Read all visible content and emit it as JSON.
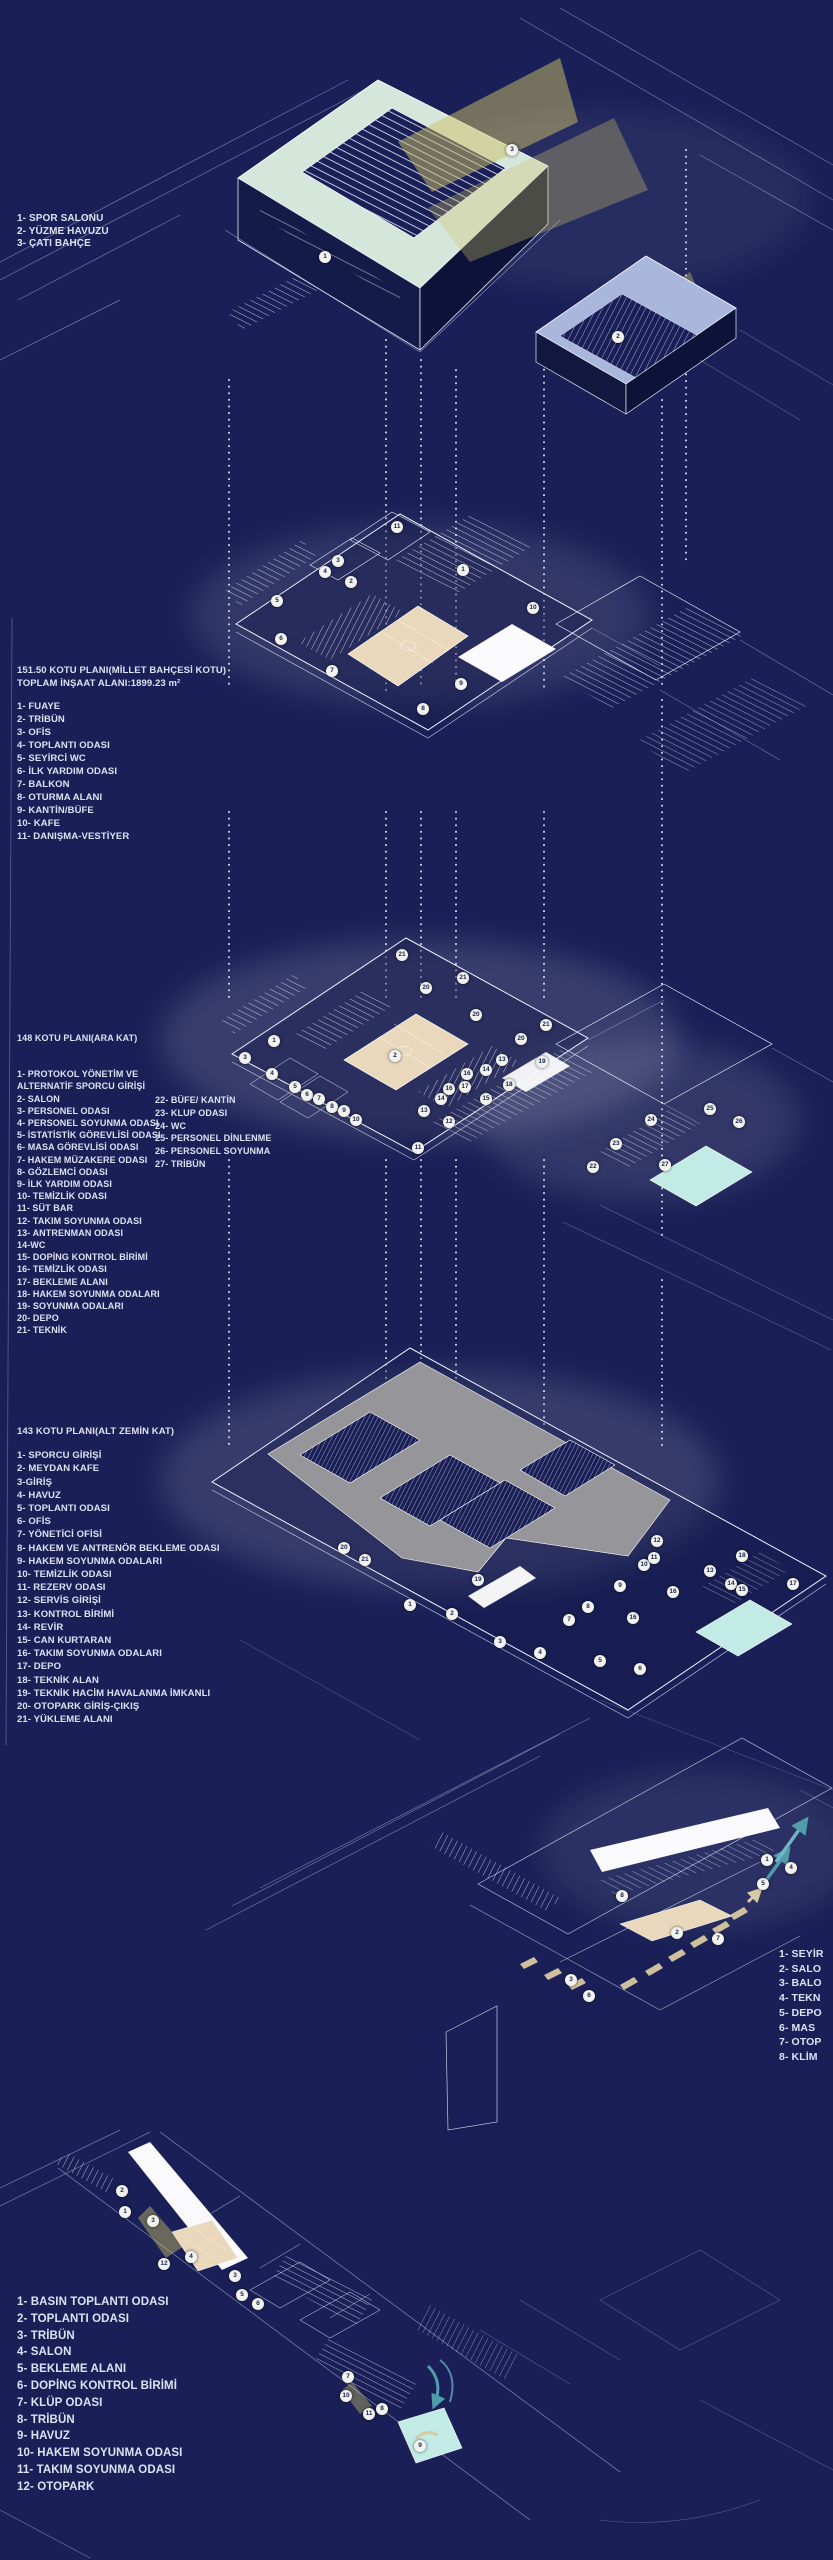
{
  "colors": {
    "background": "#1a2057",
    "line": "#dfe6f6",
    "court": "#ead8bd",
    "pool_water": "#c2ebe5",
    "parking_deck": "#96969a",
    "roof_garden": "#d5e6db",
    "pool_building_roof": "#a9b7dd",
    "light_beam": "#cdc267",
    "air_arrow_tan": "#d9c9a2",
    "air_arrow_teal": "#4f9cab",
    "text": "#dce2f1"
  },
  "legends": {
    "roof": {
      "items": [
        "1- SPOR SALONU",
        "2- YÜZME HAVUZU",
        "3- ÇATI BAHÇE"
      ]
    },
    "level_15150": {
      "title1": "151.50 KOTU PLANI(MİLLET BAHÇESİ KOTU)",
      "title2": "TOPLAM İNŞAAT ALANI:1899.23 m²",
      "items": [
        "1- FUAYE",
        "2- TRİBÜN",
        "3- OFİS",
        "4- TOPLANTI ODASI",
        "5- SEYİRCİ WC",
        "6- İLK YARDIM ODASI",
        "7- BALKON",
        "8- OTURMA ALANI",
        "9- KANTİN/BÜFE",
        "10- KAFE",
        "11- DANIŞMA-VESTİYER"
      ]
    },
    "level_148": {
      "title": "148 KOTU PLANI(ARA KAT)",
      "items_col1": [
        "1- PROTOKOL YÖNETİM VE ALTERNATİF SPORCU GİRİŞİ",
        "2- SALON",
        "3- PERSONEL ODASI",
        "4- PERSONEL SOYUNMA ODASI",
        "5- İSTATİSTİK GÖREVLİSİ ODASI",
        "6- MASA GÖREVLİSİ ODASI",
        "7- HAKEM MÜZAKERE ODASI",
        "8- GÖZLEMCİ ODASI",
        "9- İLK YARDIM ODASI",
        "10- TEMİZLİK ODASI",
        "11- SÜT BAR",
        "12- TAKIM SOYUNMA ODASI",
        "13- ANTRENMAN ODASI",
        "14-WC",
        "15- DOPİNG KONTROL BİRİMİ",
        "16- TEMİZLİK ODASI",
        "17- BEKLEME ALANI",
        "18- HAKEM SOYUNMA ODALARI",
        "19- SOYUNMA ODALARI",
        "20- DEPO",
        "21- TEKNİK"
      ],
      "items_col2": [
        "22- BÜFE/ KANTİN",
        "23- KLUP ODASI",
        "24- WC",
        "25- PERSONEL DİNLENME",
        "26- PERSONEL SOYUNMA",
        "27- TRİBÜN"
      ]
    },
    "level_143": {
      "title": "143 KOTU PLANI(ALT ZEMİN KAT)",
      "items": [
        "1- SPORCU GİRİŞİ",
        "2- MEYDAN KAFE",
        "3-GİRİŞ",
        "4- HAVUZ",
        "5- TOPLANTI ODASI",
        "6- OFİS",
        "7- YÖNETİCİ OFİSİ",
        "8- HAKEM VE ANTRENÖR BEKLEME ODASI",
        "9- HAKEM SOYUNMA ODALARI",
        "10- TEMİZLİK ODASI",
        "11- REZERV ODASI",
        "12- SERVİS GİRİŞİ",
        "13- KONTROL BİRİMİ",
        "14- REVİR",
        "15- CAN KURTARAN",
        "16- TAKIM SOYUNMA ODALARI",
        "17- DEPO",
        "18- TEKNİK ALAN",
        "19- TEKNİK HACİM HAVALANMA İMKANLI",
        "20- OTOPARK GİRİŞ-ÇIKIŞ",
        "21- YÜKLEME ALANI"
      ]
    },
    "section_right": {
      "items": [
        "1- SEYİR",
        "2- SALO",
        "3- BALO",
        "4- TEKN",
        "5- DEPO",
        "6- MAS",
        "7- OTOP",
        "8- KLİM"
      ]
    },
    "bottom": {
      "items": [
        "1- BASIN TOPLANTI ODASI",
        "2- TOPLANTI ODASI",
        "3- TRİBÜN",
        "4- SALON",
        "5- BEKLEME ALANI",
        "6- DOPİNG KONTROL BİRİMİ",
        "7- KLÜP ODASI",
        "8- TRİBÜN",
        "9- HAVUZ",
        "10- HAKEM SOYUNMA ODASI",
        "11- TAKIM SOYUNMA ODASI",
        "12- OTOPARK"
      ]
    }
  },
  "markers": {
    "roof_level": [
      {
        "n": "1",
        "x": 325,
        "y": 257
      },
      {
        "n": "3",
        "x": 512,
        "y": 150
      },
      {
        "n": "2",
        "x": 618,
        "y": 337
      }
    ],
    "level_15150": [
      {
        "n": "11",
        "x": 397,
        "y": 527
      },
      {
        "n": "3",
        "x": 338,
        "y": 561
      },
      {
        "n": "4",
        "x": 325,
        "y": 572
      },
      {
        "n": "2",
        "x": 351,
        "y": 582
      },
      {
        "n": "1",
        "x": 463,
        "y": 570
      },
      {
        "n": "5",
        "x": 277,
        "y": 601
      },
      {
        "n": "10",
        "x": 533,
        "y": 608
      },
      {
        "n": "6",
        "x": 281,
        "y": 639
      },
      {
        "n": "7",
        "x": 332,
        "y": 671
      },
      {
        "n": "9",
        "x": 461,
        "y": 684
      },
      {
        "n": "8",
        "x": 423,
        "y": 709
      }
    ],
    "level_148": [
      {
        "n": "21",
        "x": 402,
        "y": 955
      },
      {
        "n": "21",
        "x": 463,
        "y": 978
      },
      {
        "n": "20",
        "x": 426,
        "y": 988
      },
      {
        "n": "20",
        "x": 476,
        "y": 1015
      },
      {
        "n": "20",
        "x": 521,
        "y": 1039
      },
      {
        "n": "21",
        "x": 546,
        "y": 1025
      },
      {
        "n": "1",
        "x": 274,
        "y": 1041
      },
      {
        "n": "2",
        "x": 395,
        "y": 1056
      },
      {
        "n": "3",
        "x": 245,
        "y": 1058
      },
      {
        "n": "4",
        "x": 272,
        "y": 1074
      },
      {
        "n": "5",
        "x": 295,
        "y": 1087
      },
      {
        "n": "6",
        "x": 307,
        "y": 1095
      },
      {
        "n": "7",
        "x": 319,
        "y": 1099
      },
      {
        "n": "8",
        "x": 332,
        "y": 1107
      },
      {
        "n": "9",
        "x": 344,
        "y": 1111
      },
      {
        "n": "10",
        "x": 356,
        "y": 1120
      },
      {
        "n": "11",
        "x": 418,
        "y": 1148
      },
      {
        "n": "12",
        "x": 449,
        "y": 1122
      },
      {
        "n": "13",
        "x": 424,
        "y": 1111
      },
      {
        "n": "14",
        "x": 441,
        "y": 1099
      },
      {
        "n": "16",
        "x": 449,
        "y": 1089
      },
      {
        "n": "17",
        "x": 465,
        "y": 1087
      },
      {
        "n": "16",
        "x": 467,
        "y": 1074
      },
      {
        "n": "14",
        "x": 486,
        "y": 1070
      },
      {
        "n": "15",
        "x": 486,
        "y": 1099
      },
      {
        "n": "13",
        "x": 502,
        "y": 1060
      },
      {
        "n": "18",
        "x": 509,
        "y": 1085
      },
      {
        "n": "19",
        "x": 542,
        "y": 1062
      },
      {
        "n": "22",
        "x": 593,
        "y": 1167
      },
      {
        "n": "23",
        "x": 616,
        "y": 1144
      },
      {
        "n": "24",
        "x": 651,
        "y": 1120
      },
      {
        "n": "25",
        "x": 710,
        "y": 1109
      },
      {
        "n": "26",
        "x": 739,
        "y": 1122
      },
      {
        "n": "27",
        "x": 665,
        "y": 1165
      }
    ],
    "level_143": [
      {
        "n": "20",
        "x": 344,
        "y": 1548
      },
      {
        "n": "21",
        "x": 365,
        "y": 1560
      },
      {
        "n": "1",
        "x": 410,
        "y": 1605
      },
      {
        "n": "2",
        "x": 452,
        "y": 1614
      },
      {
        "n": "19",
        "x": 478,
        "y": 1580
      },
      {
        "n": "3",
        "x": 500,
        "y": 1642
      },
      {
        "n": "4",
        "x": 540,
        "y": 1653
      },
      {
        "n": "5",
        "x": 600,
        "y": 1661
      },
      {
        "n": "6",
        "x": 640,
        "y": 1669
      },
      {
        "n": "7",
        "x": 569,
        "y": 1620
      },
      {
        "n": "8",
        "x": 588,
        "y": 1607
      },
      {
        "n": "9",
        "x": 620,
        "y": 1586
      },
      {
        "n": "10",
        "x": 644,
        "y": 1565
      },
      {
        "n": "11",
        "x": 654,
        "y": 1558
      },
      {
        "n": "12",
        "x": 657,
        "y": 1541
      },
      {
        "n": "16",
        "x": 673,
        "y": 1592
      },
      {
        "n": "16",
        "x": 633,
        "y": 1618
      },
      {
        "n": "13",
        "x": 710,
        "y": 1571
      },
      {
        "n": "14",
        "x": 731,
        "y": 1584
      },
      {
        "n": "15",
        "x": 742,
        "y": 1590
      },
      {
        "n": "18",
        "x": 742,
        "y": 1556
      },
      {
        "n": "17",
        "x": 793,
        "y": 1584
      }
    ],
    "section": [
      {
        "n": "8",
        "x": 622,
        "y": 1896
      },
      {
        "n": "2",
        "x": 677,
        "y": 1933
      },
      {
        "n": "7",
        "x": 718,
        "y": 1939
      },
      {
        "n": "3",
        "x": 571,
        "y": 1980
      },
      {
        "n": "6",
        "x": 589,
        "y": 1996
      },
      {
        "n": "1",
        "x": 767,
        "y": 1860
      },
      {
        "n": "5",
        "x": 763,
        "y": 1884
      },
      {
        "n": "4",
        "x": 791,
        "y": 1868
      }
    ],
    "bottom": [
      {
        "n": "2",
        "x": 122,
        "y": 2191
      },
      {
        "n": "1",
        "x": 125,
        "y": 2212
      },
      {
        "n": "3",
        "x": 153,
        "y": 2221
      },
      {
        "n": "4",
        "x": 191,
        "y": 2257
      },
      {
        "n": "12",
        "x": 164,
        "y": 2264
      },
      {
        "n": "3",
        "x": 235,
        "y": 2276
      },
      {
        "n": "5",
        "x": 242,
        "y": 2295
      },
      {
        "n": "6",
        "x": 258,
        "y": 2304
      },
      {
        "n": "7",
        "x": 348,
        "y": 2377
      },
      {
        "n": "10",
        "x": 346,
        "y": 2396
      },
      {
        "n": "11",
        "x": 369,
        "y": 2414
      },
      {
        "n": "8",
        "x": 382,
        "y": 2409
      },
      {
        "n": "9",
        "x": 420,
        "y": 2446
      }
    ]
  }
}
